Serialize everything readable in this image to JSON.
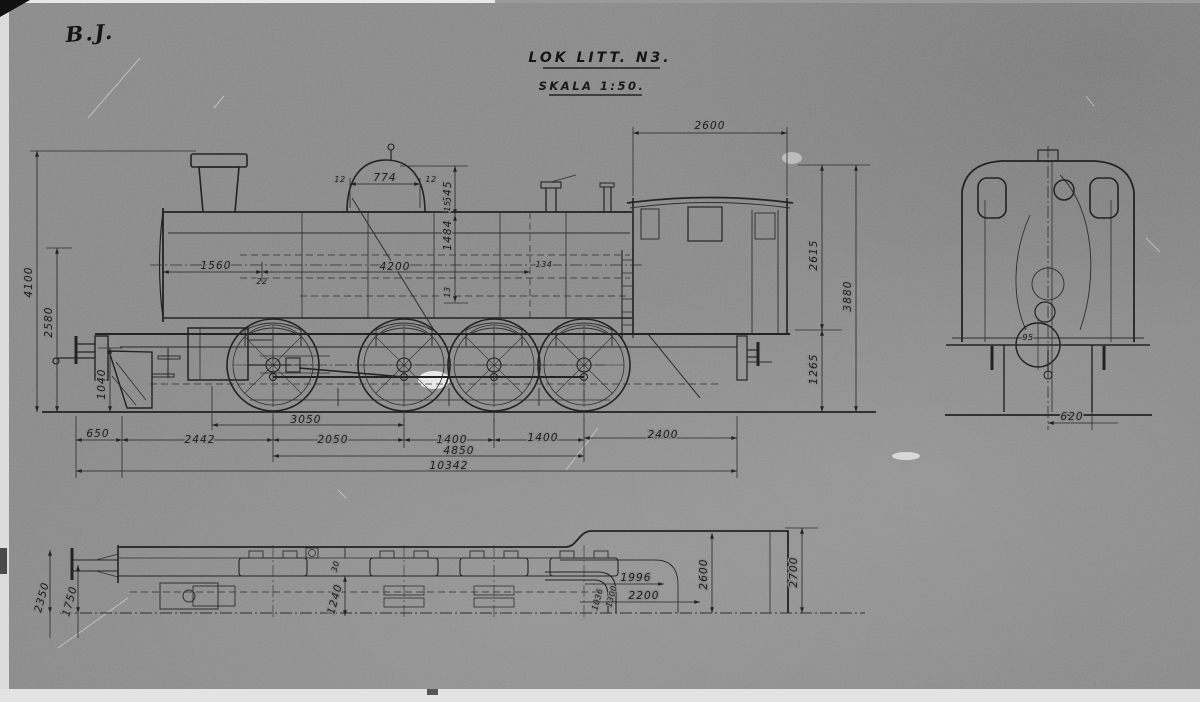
{
  "photo": {
    "corner_mark": "B.J."
  },
  "title": {
    "name": "LOK LITT. N3.",
    "scale": "SKALA 1:50."
  },
  "side_view": {
    "top": {
      "cab_length": "2600"
    },
    "dome": {
      "width": "774",
      "left_small": "12",
      "right_small": "12",
      "height": "645"
    },
    "vertical_chain": {
      "boiler_depth": "1484",
      "small_top": "15",
      "small_bottom": "13"
    },
    "horizontal_chain": {
      "smokebox": "1560",
      "plate": "22",
      "boiler_length": "4200",
      "small_end": "134"
    },
    "left": {
      "chimney_height": "4100",
      "boiler_center_height": "2580",
      "buffer_height": "1040"
    },
    "right": {
      "upper": "2615",
      "overall_height": "3880",
      "lower": "1265"
    },
    "bottom": {
      "front_overhang": "650",
      "buffer_to_axle1": "2442",
      "cylinder_to_axle2": "3050",
      "axle1_2": "2050",
      "axle2_3": "1400",
      "axle3_4": "1400",
      "rear_overhang": "2400",
      "coupled_wheelbase": "4850",
      "total_length": "10342"
    }
  },
  "front_view": {
    "cylinder_label": "95",
    "half_width": "620"
  },
  "plan_view": {
    "left_outer": "2350",
    "left_inner": "1750",
    "edge_offset": "30",
    "frame_half_width": "1240",
    "pipe_a": "1036",
    "pipe_b": "1300",
    "bunker_width": "1996",
    "bunker_length": "2200",
    "cab_width": "2600",
    "overall_width": "2700"
  }
}
